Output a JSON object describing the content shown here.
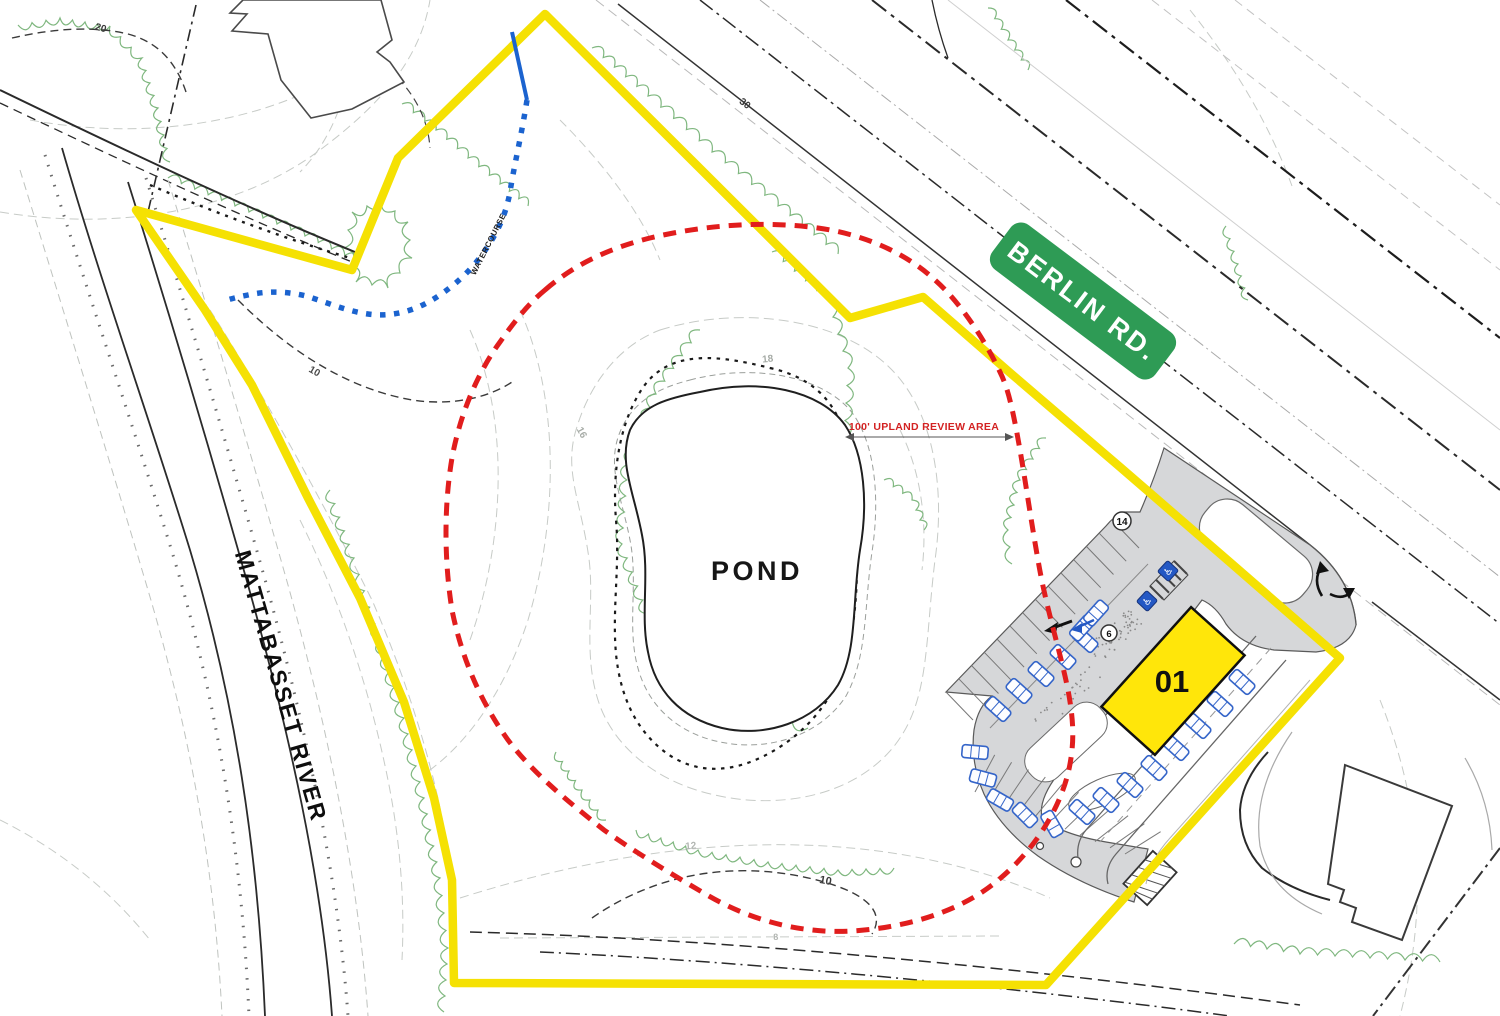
{
  "canvas": {
    "width": 1500,
    "height": 1016,
    "background": "#ffffff"
  },
  "labels": {
    "road_badge": "BERLIN RD.",
    "river": "MATTABASSET RIVER",
    "pond": "POND",
    "building_number": "01",
    "upland_note": "100' UPLAND REVIEW AREA",
    "watercourse": "WATERCOURSE"
  },
  "parking": {
    "upper_count": "14",
    "island_count": "6"
  },
  "contour_labels": [
    {
      "text": "20",
      "x": 100,
      "y": 31,
      "rot": 15,
      "size": 10,
      "color": "#3a3a3a"
    },
    {
      "text": "30",
      "x": 743,
      "y": 106,
      "rot": 38,
      "size": 10,
      "color": "#3a3a3a"
    },
    {
      "text": "10",
      "x": 313,
      "y": 374,
      "rot": 30,
      "size": 10,
      "color": "#4a4a4a"
    },
    {
      "text": "18",
      "x": 768,
      "y": 362,
      "rot": -6,
      "size": 10,
      "color": "#a7aca7"
    },
    {
      "text": "16",
      "x": 579,
      "y": 434,
      "rot": 62,
      "size": 10,
      "color": "#a7aca7"
    },
    {
      "text": "12",
      "x": 691,
      "y": 849,
      "rot": -5,
      "size": 10,
      "color": "#b3b7b3"
    },
    {
      "text": "10",
      "x": 825,
      "y": 884,
      "rot": 10,
      "size": 11,
      "color": "#3a3a3a"
    },
    {
      "text": "8",
      "x": 776,
      "y": 940,
      "rot": -4,
      "size": 9,
      "color": "#b3b7b3"
    }
  ],
  "colors": {
    "boundary_yellow": "#F5E103",
    "upland_red": "#E11D1D",
    "watercourse_blue": "#1B63CF",
    "road_badge_green": "#2E9B55",
    "badge_text": "#FFFFFF",
    "building_fill": "#FFE60A",
    "pavement_gray": "#D6D7D9",
    "tree_green": "#7FB77F",
    "car_blue": "#3565C9"
  }
}
